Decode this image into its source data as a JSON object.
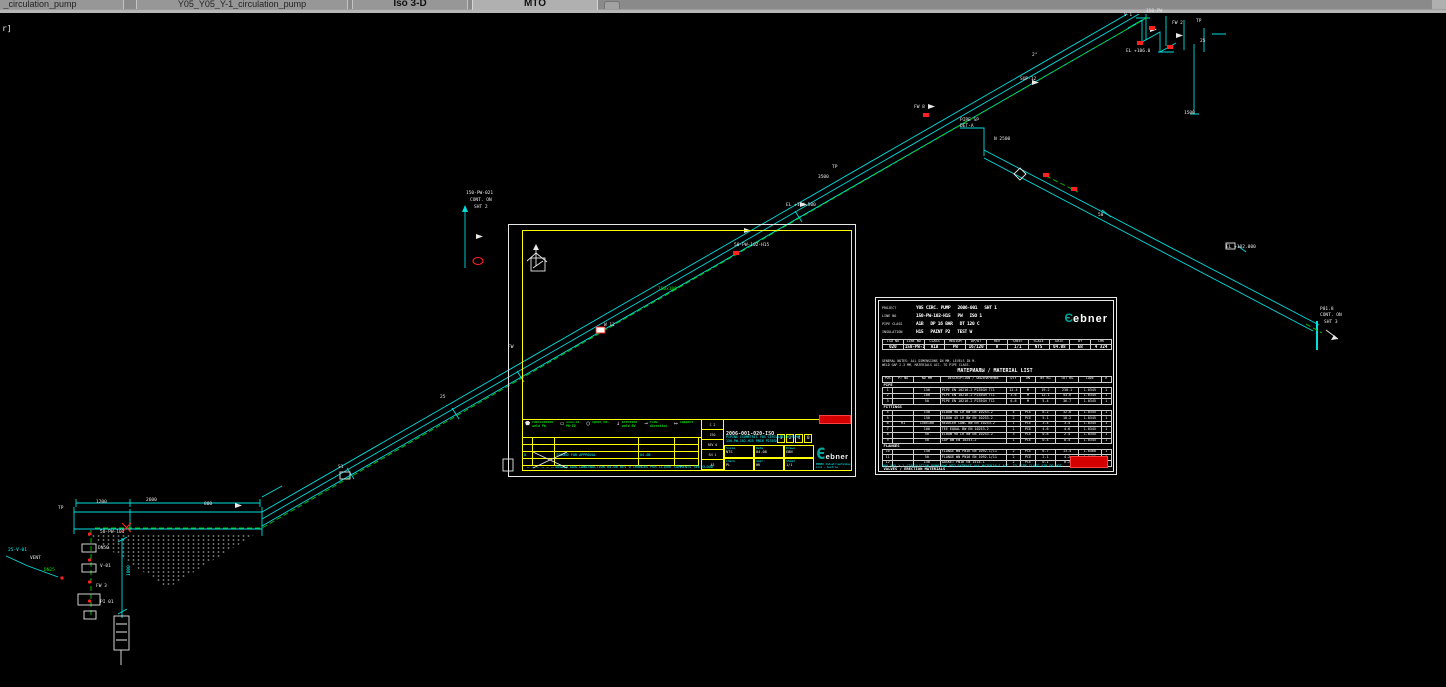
{
  "colors": {
    "line_cyan": "#00dede",
    "line_green": "#00c800",
    "frame_yellow": "#ffff00",
    "marker_red": "#ff2020",
    "w": "#e8e8e8",
    "c": "#00ffff",
    "g": "#00dc00",
    "r": "#ff4040",
    "logo_teal": "#00a79b"
  },
  "tabs": [
    {
      "label": "_circulation_pump",
      "active": false,
      "short": false
    },
    {
      "label": "Y05_Y05_Y-1_circulation_pump",
      "active": false,
      "short": false
    },
    {
      "label": "Iso 3-D",
      "active": false,
      "short": true
    },
    {
      "label": "MTO",
      "active": true,
      "short": true
    }
  ],
  "canvas": {
    "corner_text": "r]",
    "annotations": [
      {
        "x": 2,
        "y": 11,
        "t": "r]",
        "c": "w",
        "s": 8
      },
      {
        "x": 8,
        "y": 535,
        "t": "25-V-01",
        "c": "c"
      },
      {
        "x": 30,
        "y": 543,
        "t": "VENT",
        "c": "w"
      },
      {
        "x": 44,
        "y": 555,
        "t": "DN25",
        "c": "g"
      },
      {
        "x": 58,
        "y": 493,
        "t": "TP",
        "c": "w"
      },
      {
        "x": 96,
        "y": 487,
        "t": "1200",
        "c": "w"
      },
      {
        "x": 146,
        "y": 485,
        "t": "2600",
        "c": "w"
      },
      {
        "x": 204,
        "y": 489,
        "t": "800",
        "c": "w"
      },
      {
        "x": 100,
        "y": 517,
        "t": "50-PW-101",
        "c": "w"
      },
      {
        "x": 98,
        "y": 533,
        "t": "DN50",
        "c": "w"
      },
      {
        "x": 100,
        "y": 551,
        "t": "V-01",
        "c": "w"
      },
      {
        "x": 96,
        "y": 571,
        "t": "FW 3",
        "c": "w"
      },
      {
        "x": 100,
        "y": 587,
        "t": "PI 01",
        "c": "w"
      },
      {
        "x": 128,
        "y": 562,
        "t": "1800",
        "c": "c",
        "r": 1
      },
      {
        "x": 338,
        "y": 452,
        "t": "S1",
        "c": "w"
      },
      {
        "x": 440,
        "y": 382,
        "t": "25",
        "c": "w"
      },
      {
        "x": 466,
        "y": 178,
        "t": "150-PW-021",
        "c": "w"
      },
      {
        "x": 470,
        "y": 185,
        "t": "CONT. ON",
        "c": "w"
      },
      {
        "x": 474,
        "y": 192,
        "t": "SHT 2",
        "c": "w"
      },
      {
        "x": 508,
        "y": 332,
        "t": "FW",
        "c": "w"
      },
      {
        "x": 604,
        "y": 310,
        "t": "W 12",
        "c": "w"
      },
      {
        "x": 658,
        "y": 274,
        "t": "150x100",
        "c": "g"
      },
      {
        "x": 734,
        "y": 230,
        "t": "50-PW-102-H15",
        "c": "w"
      },
      {
        "x": 786,
        "y": 190,
        "t": "EL +104.500",
        "c": "w"
      },
      {
        "x": 818,
        "y": 162,
        "t": "3500",
        "c": "w"
      },
      {
        "x": 832,
        "y": 152,
        "t": "TP",
        "c": "w"
      },
      {
        "x": 914,
        "y": 92,
        "t": "FW 8",
        "c": "w"
      },
      {
        "x": 1020,
        "y": 64,
        "t": "SUP-12",
        "c": "w"
      },
      {
        "x": 1032,
        "y": 40,
        "t": "2°",
        "c": "w"
      },
      {
        "x": 960,
        "y": 105,
        "t": "PIPE SP",
        "c": "w"
      },
      {
        "x": 960,
        "y": 111,
        "t": "DET-A",
        "c": "w"
      },
      {
        "x": 994,
        "y": 124,
        "t": "N 2500",
        "c": "w"
      },
      {
        "x": 1098,
        "y": 200,
        "t": "50",
        "c": "w"
      },
      {
        "x": 1226,
        "y": 232,
        "t": "EL +102.000",
        "c": "w"
      },
      {
        "x": 1320,
        "y": 294,
        "t": "P01.8",
        "c": "w"
      },
      {
        "x": 1320,
        "y": 300,
        "t": "CONT. ON",
        "c": "w"
      },
      {
        "x": 1324,
        "y": 307,
        "t": "SHT 3",
        "c": "w"
      },
      {
        "x": 1124,
        "y": 0,
        "t": "V 1",
        "c": "w"
      },
      {
        "x": 1146,
        "y": -4,
        "t": "150-PW",
        "c": "w"
      },
      {
        "x": 1172,
        "y": 8,
        "t": "FW 2",
        "c": "w"
      },
      {
        "x": 1196,
        "y": 6,
        "t": "TP",
        "c": "w"
      },
      {
        "x": 1126,
        "y": 36,
        "t": "EL +106.0",
        "c": "w"
      },
      {
        "x": 1200,
        "y": 26,
        "t": "25",
        "c": "w"
      },
      {
        "x": 1184,
        "y": 98,
        "t": "1500",
        "c": "w"
      }
    ]
  },
  "titleblock": {
    "legend": [
      {
        "sym": "⬟",
        "lines": [
          "Fabrication",
          "weld FW"
        ]
      },
      {
        "sym": "▭",
        "lines": [
          "1333.33",
          "PN-ID"
        ]
      },
      {
        "sym": "○",
        "lines": [
          "Spool No."
        ]
      },
      {
        "sym": "↓",
        "lines": [
          "Erection",
          "weld EW"
        ]
      },
      {
        "sym": "→",
        "lines": [
          "Flow",
          "direction"
        ]
      },
      {
        "sym": "↦",
        "lines": [
          "Support"
        ]
      }
    ],
    "rev_entry": [
      "0",
      "",
      "ISSUED FOR APPROVAL",
      "04.08",
      ""
    ],
    "rev_note": "— — — — — — — — — — — — — —",
    "midcol": [
      "C 2",
      "ISO",
      "REV 0",
      "SH 1",
      "A3"
    ],
    "doc_no": "2006-001-020-ISO",
    "rev_digits": [
      "3",
      "2",
      "4",
      "0"
    ],
    "title_lines": [
      "PIPING ISOMETRIC  Y05 CIRCULATION PUMP",
      "150-PW-102-H15   PN16   P235GH"
    ],
    "cells": [
      {
        "l": "Scale",
        "v": "NTS"
      },
      {
        "l": "Date",
        "v": "04.08"
      },
      {
        "l": "Drawn",
        "v": "EBN"
      },
      {
        "l": "Check",
        "v": "PL"
      },
      {
        "l": "Appr.",
        "v": "HK"
      },
      {
        "l": "Sheet",
        "v": "1/1"
      }
    ],
    "logo_word": "ebner",
    "logo_sub": [
      "EBNER Industrieofenbau",
      "Linz - Austria"
    ],
    "footer": "ISSUED FOR CONSTRUCTION  04.08  REV 0  CHANGES PER CLIENT COMMENTS  SEE CLOUD"
  },
  "mto": {
    "logo_word": "ebner",
    "info_rows": [
      {
        "label": "PROJECT",
        "values": [
          "Y05 CIRC. PUMP",
          "2006-001",
          "SHT 1"
        ]
      },
      {
        "label": "LINE NO",
        "values": [
          "150-PW-102-H15",
          "PW",
          "ISO 1"
        ]
      },
      {
        "label": "PIPE CLASS",
        "values": [
          "A1B",
          "DP 16 BAR",
          "DT 120 C"
        ]
      },
      {
        "label": "INSULATION",
        "values": [
          "H15",
          "PAINT P2",
          "TEST W"
        ]
      }
    ],
    "head_cols": [
      "ISO NO",
      "LINE NO",
      "CLASS",
      "MEDIUM",
      "DP/DT",
      "REV",
      "SHEET",
      "SCALE",
      "DATE",
      "BY",
      "CHK"
    ],
    "head_vals": [
      "020",
      "150-PW-102",
      "A1B",
      "PW",
      "16/120",
      "0",
      "1/1",
      "NTS",
      "04.08",
      "EB",
      "4 324"
    ],
    "note_lines": [
      "GENERAL NOTES: ALL DIMENSIONS IN MM, LEVELS IN M.",
      "WELD GAP 2-3 MM. MATERIALS ACC. TO PIPE CLASS."
    ],
    "title": "МАТЕРИАЛЫ / MATERIAL LIST",
    "cols": [
      "POS",
      "PT NO",
      "ND MM",
      "DESCRIPTION / ОБОЗНАЧЕНИЕ",
      "QTY",
      "UN",
      "WT KG",
      "TOT KG",
      "CODE",
      "R"
    ],
    "sections": [
      {
        "name": "PIPE",
        "rows": [
          {
            "pos": "1",
            "pt": "",
            "nd": "150",
            "desc": "PIPE EN 10216-2 P235GH TC1",
            "qty": "12.4",
            "un": "M",
            "w1": "19.2",
            "w2": "238.1",
            "code": "1.0345",
            "r": "1"
          },
          {
            "pos": "2",
            "pt": "",
            "nd": "100",
            "desc": "PIPE EN 10216-2 P235GH TC1",
            "qty": "3.6",
            "un": "M",
            "w1": "12.1",
            "w2": "43.6",
            "code": "1.0345",
            "r": "1"
          },
          {
            "pos": "3",
            "pt": "",
            "nd": "50",
            "desc": "PIPE EN 10216-2 P235GH TC1",
            "qty": "6.8",
            "un": "M",
            "w1": "5.4",
            "w2": "36.7",
            "code": "1.0345",
            "r": "1"
          }
        ]
      },
      {
        "name": "FITTINGS",
        "rows": [
          {
            "pos": "4",
            "pt": "",
            "nd": "150",
            "desc": "ELBOW 90 LR BW EN 10253-2",
            "qty": "4",
            "un": "PCE",
            "w1": "8.2",
            "w2": "32.8",
            "code": "1.0345",
            "r": "1"
          },
          {
            "pos": "5",
            "pt": "",
            "nd": "150",
            "desc": "ELBOW 45 LR BW EN 10253-2",
            "qty": "2",
            "un": "PCE",
            "w1": "5.1",
            "w2": "10.2",
            "code": "1.0345",
            "r": "1"
          },
          {
            "pos": "6",
            "pt": "R1",
            "nd": "150x100",
            "desc": "REDUCER CONC BW EN 10253-2",
            "qty": "1",
            "un": "PCE",
            "w1": "3.4",
            "w2": "3.4",
            "code": "1.0345",
            "r": "1"
          },
          {
            "pos": "7",
            "pt": "",
            "nd": "100",
            "desc": "TEE EQUAL BW EN 10253-2",
            "qty": "1",
            "un": "PCE",
            "w1": "4.6",
            "w2": "4.6",
            "code": "1.0345",
            "r": "1"
          },
          {
            "pos": "8",
            "pt": "",
            "nd": "50",
            "desc": "ELBOW 90 LR BW EN 10253-2",
            "qty": "3",
            "un": "PCE",
            "w1": "0.8",
            "w2": "2.4",
            "code": "1.0345",
            "r": "1"
          },
          {
            "pos": "9",
            "pt": "",
            "nd": "50",
            "desc": "CAP BW EN 10253-2",
            "qty": "1",
            "un": "PCE",
            "w1": "0.4",
            "w2": "0.4",
            "code": "1.0345",
            "r": "1"
          }
        ]
      },
      {
        "name": "FLANGES",
        "rows": [
          {
            "pos": "10",
            "pt": "",
            "nd": "150",
            "desc": "FLANGE WN PN16 EN 1092-1/11",
            "qty": "2",
            "un": "PCE",
            "w1": "6.7",
            "w2": "13.4",
            "code": "1.0460",
            "r": "1"
          },
          {
            "pos": "11",
            "pt": "",
            "nd": "50",
            "desc": "FLANGE WN PN16 EN 1092-1/11",
            "qty": "2",
            "un": "PCE",
            "w1": "2.1",
            "w2": "4.2",
            "code": "1.0460",
            "r": "1"
          },
          {
            "pos": "12",
            "pt": "",
            "nd": "150",
            "desc": "GASKET PN16 EN 1514-1",
            "qty": "2",
            "un": "PCE",
            "w1": "0.1",
            "w2": "0.2",
            "code": "IT200",
            "r": "1"
          }
        ]
      },
      {
        "name": "VALVES / ERECTION MATERIALS",
        "rows": [
          {
            "pos": "13",
            "pt": "V-01",
            "nd": "50",
            "desc": "GLOBE VALVE PN16 FLGD / ВЕНТИЛЬ ЗАПОРНЫЙ",
            "qty": "1",
            "un": "PCE",
            "w1": "14.0",
            "w2": "14.0",
            "code": "GG25",
            "r": "2"
          }
        ]
      }
    ],
    "footer_note": "Y05_Y05_Y-1_CIRCULATION_PUMP.DWG  MTO EXTRACT  ALL MATERIALS ACC. TO PIPE CLASS A1B  DO NOT SCALE"
  }
}
